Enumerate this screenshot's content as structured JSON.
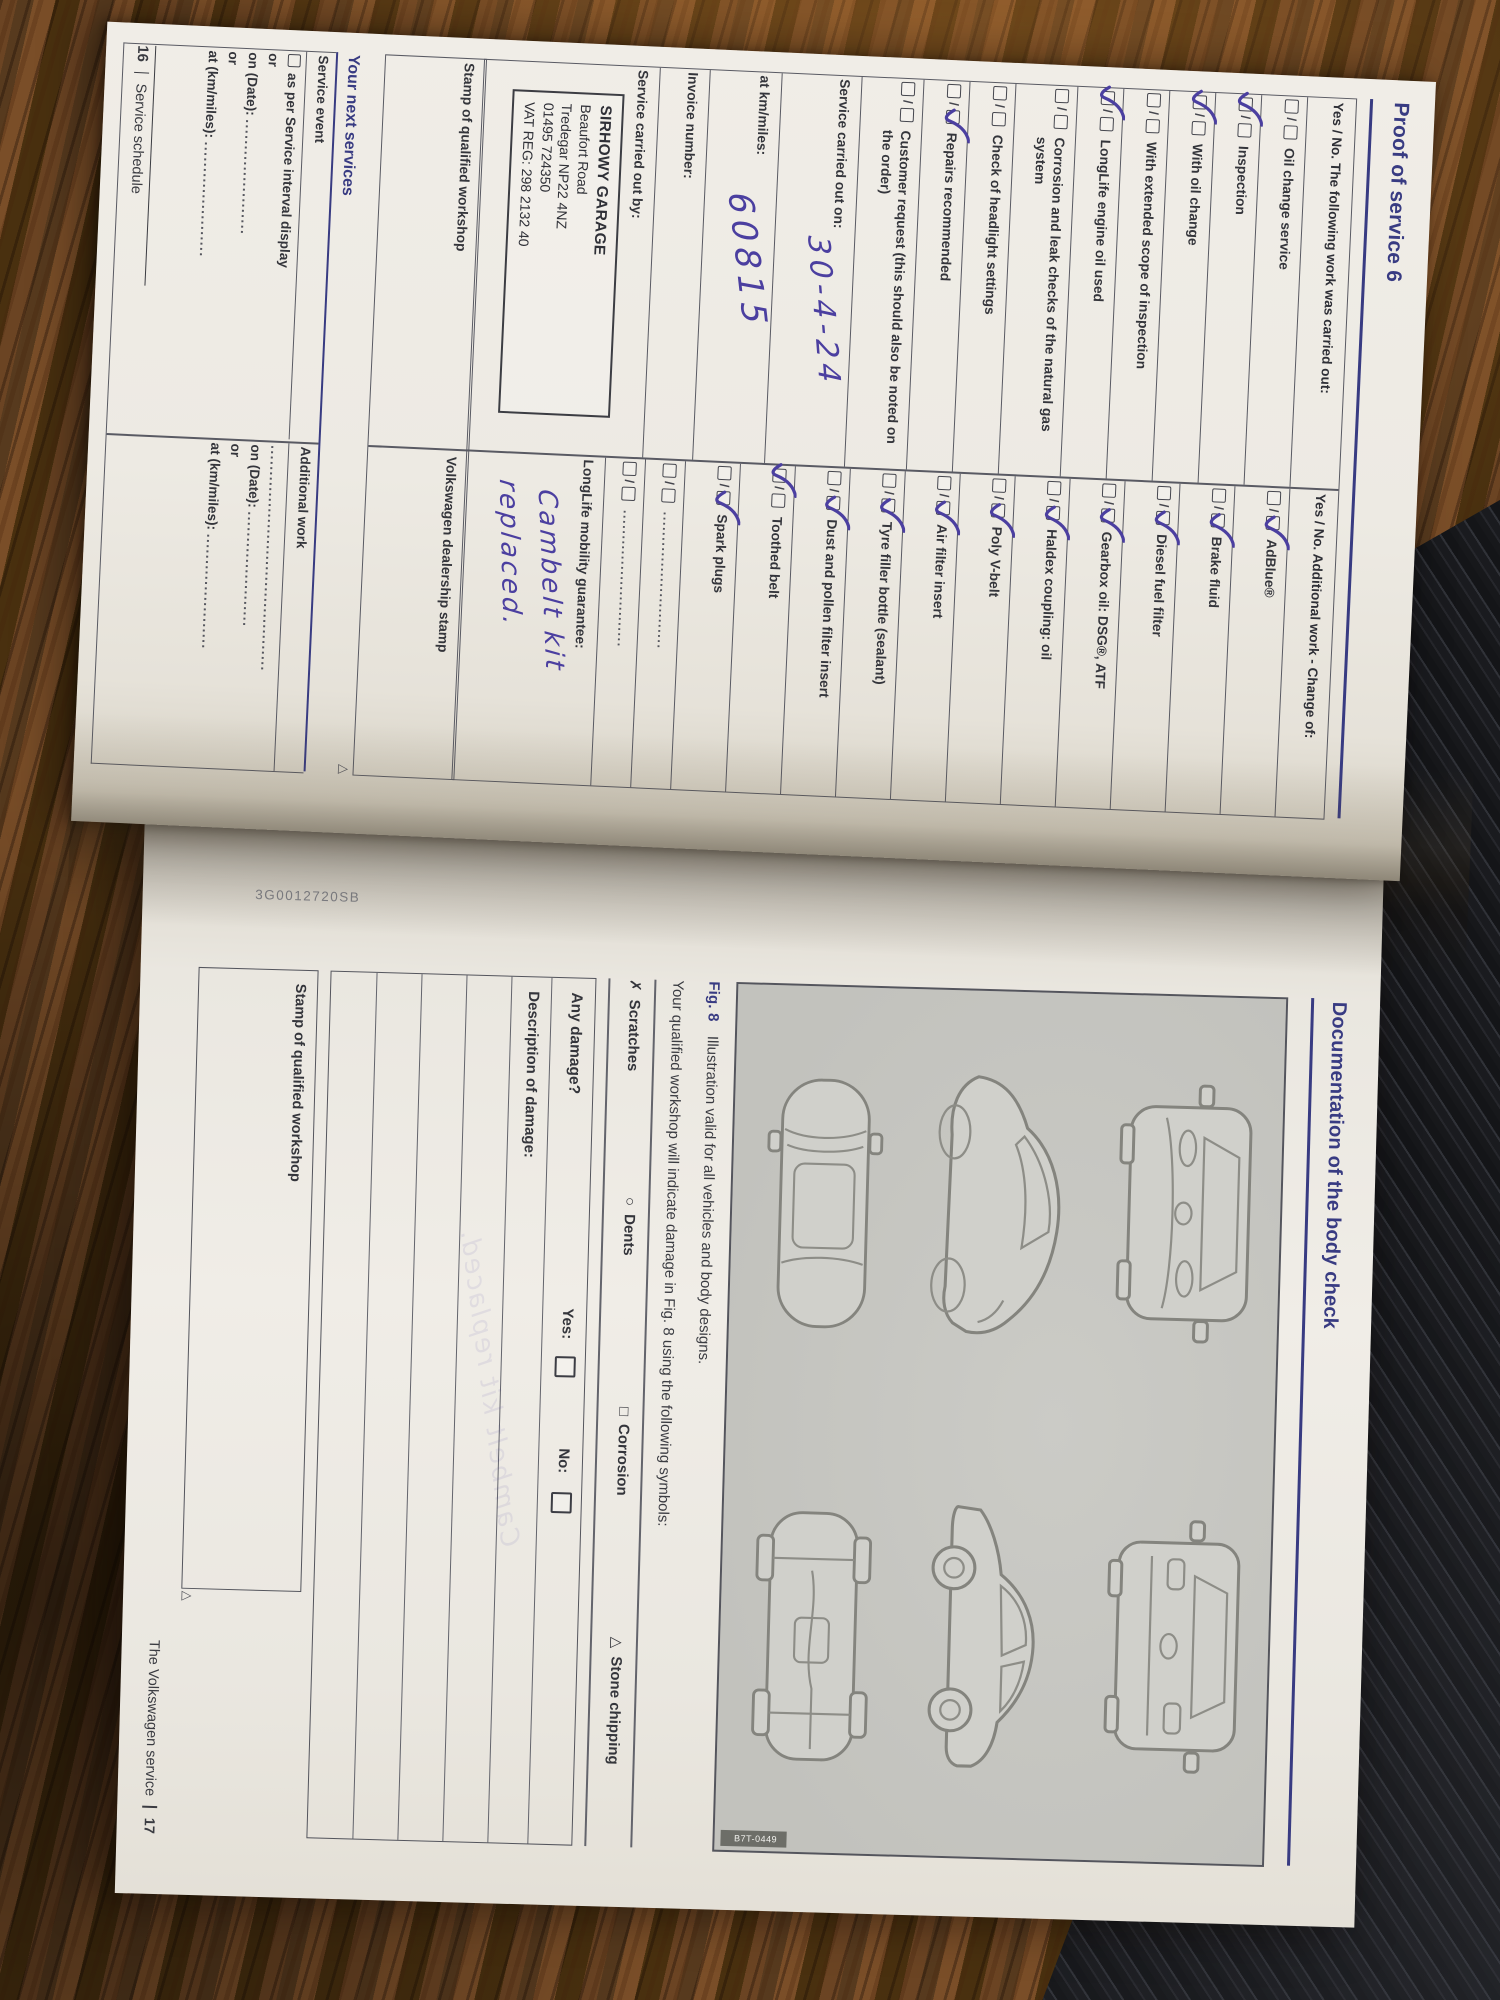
{
  "colors": {
    "accent_blue": "#383b82",
    "ink_blue": "#4b3fa0",
    "paper": "#edeae3",
    "panel_gray": "#c6c6c1",
    "wood": "#5e3f22",
    "dark_surface": "#191a1d"
  },
  "booklet": {
    "slash": "/",
    "left_page": {
      "heading": "Proof of service 6",
      "col_left_header": "Yes / No. The following work was carried out:",
      "col_right_header": "Yes / No. Additional work - Change of:",
      "left_items": [
        {
          "label": "Oil change service",
          "tick": "none"
        },
        {
          "label": "Inspection",
          "tick": "yes"
        },
        {
          "label": "With oil change",
          "tick": "yes"
        },
        {
          "label": "With extended scope of inspection",
          "tick": "none"
        },
        {
          "label": "LongLife engine oil used",
          "tick": "yes"
        },
        {
          "label": "Corrosion and leak checks of the natural gas system",
          "tick": "none"
        },
        {
          "label": "Check of headlight settings",
          "tick": "none"
        },
        {
          "label": "Repairs recommended",
          "tick": "no"
        },
        {
          "label": "Customer request (this should also be noted on the order)",
          "tick": "none"
        }
      ],
      "right_items": [
        {
          "label": "AdBlue®",
          "tick": "no"
        },
        {
          "label": "Brake fluid",
          "tick": "no"
        },
        {
          "label": "Diesel fuel filter",
          "tick": "no"
        },
        {
          "label": "Gearbox oil: DSG®, ATF",
          "tick": "no"
        },
        {
          "label": "Haldex coupling: oil",
          "tick": "no"
        },
        {
          "label": "Poly V-belt",
          "tick": "no"
        },
        {
          "label": "Air filter insert",
          "tick": "no"
        },
        {
          "label": "Tyre filler bottle (sealant)",
          "tick": "no"
        },
        {
          "label": "Dust and pollen filter insert",
          "tick": "no"
        },
        {
          "label": "Toothed belt",
          "tick": "yes"
        },
        {
          "label": "Spark plugs",
          "tick": "no"
        },
        {
          "label": "...........................",
          "tick": "none"
        },
        {
          "label": "...........................",
          "tick": "none"
        }
      ],
      "carried_out_on_label": "Service carried out on:",
      "carried_out_on_value": "30-4-24",
      "km_label": "at km/miles:",
      "km_value": "60815",
      "invoice_label": "Invoice number:",
      "carried_out_by_label": "Service carried out by:",
      "workshop_stamp_lines": {
        "l0": "SIRHOWY GARAGE",
        "l1": "Beaufort Road",
        "l2": "Tredegar  NP22 4NZ",
        "l3": "01495 724350",
        "l4": "VAT REG: 298 2132 40"
      },
      "mobility_label": "LongLife mobility guarantee:",
      "mobility_handwriting_line1": "Cambelt kit",
      "mobility_handwriting_line2": "replaced.",
      "stamp_left_label": "Stamp of qualified workshop",
      "stamp_right_label": "Volkswagen dealership stamp",
      "next_services": {
        "heading": "Your next services",
        "left_header": "Service event",
        "right_header": "Additional work",
        "interval_item": "as per Service interval display",
        "or": "or",
        "on_date_label": "on (Date): ",
        "at_km_label": "at (km/miles): ",
        "dots": "......................",
        "right_dots": "..........................................."
      },
      "footer_page_number": "16",
      "footer_label": "Service schedule",
      "corner_mark": "△"
    },
    "right_page": {
      "heading": "Documentation of the body check",
      "fig_label": "Fig. 8",
      "fig_caption": "Illustration valid for all vehicles and body designs.",
      "symbols_intro": "Your qualified workshop will indicate damage in Fig. 8 using the following symbols:",
      "symbols": [
        {
          "glyph": "✗",
          "label": "Scratches"
        },
        {
          "glyph": "○",
          "label": "Dents"
        },
        {
          "glyph": "□",
          "label": "Corrosion"
        },
        {
          "glyph": "△",
          "label": "Stone chipping"
        }
      ],
      "panel_code": "B7T-0449",
      "any_damage_label": "Any damage?",
      "yes_label": "Yes:",
      "no_label": "No:",
      "description_label": "Description of damage:",
      "stamp_label": "Stamp of qualified workshop",
      "footer_brand": "The Volkswagen service",
      "footer_page_number": "17",
      "part_number": "3G0012720SB",
      "corner_mark": "△",
      "show_through_text": "Cambelt kit replaced."
    }
  }
}
